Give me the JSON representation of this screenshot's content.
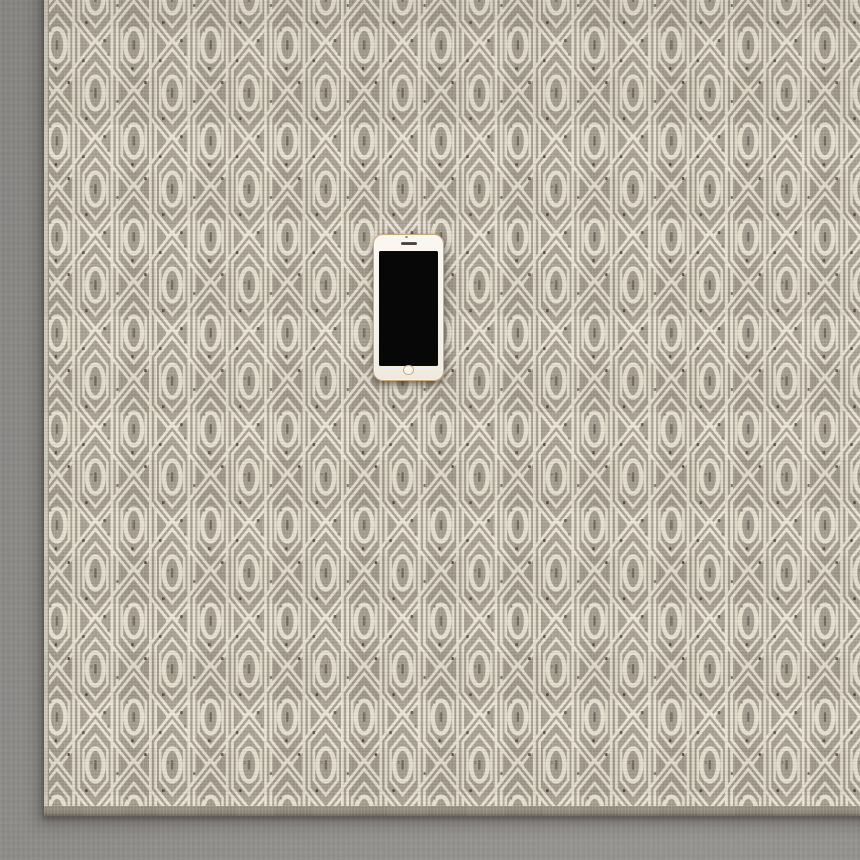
{
  "scene": {
    "description": "Overhead photo of a smartphone with its screen off, lying face-up on a gray-taupe geometric flat-weave area rug placed on a gray concrete floor",
    "floor": {
      "label": "gray concrete floor"
    },
    "rug": {
      "label": "geometric hexagon flat-weave area rug",
      "pattern": "half-drop elongated hexagons with inner outline, center oval and tip diamonds, cream on taupe, with dark woven flecks",
      "edges": {
        "left": "cream selvedge strip",
        "bottom": "dark taupe binding"
      }
    },
    "phone": {
      "label": "smartphone lying face-up",
      "state": "screen off",
      "parts": {
        "screen": "black rectangular display",
        "speaker": "earpiece speaker slot",
        "camera": "front camera dot",
        "sensor": "proximity sensor dot",
        "home_button": "circular home button with gold ring"
      }
    }
  },
  "colors": {
    "floor": "#8f8d8a",
    "floor_light": "#989693",
    "rug_ground": "#a39a8c",
    "rug_ground_dark": "#948c7f",
    "rug_cream": "#e9e2d2",
    "rug_fleck_dark": "#36322b",
    "rug_fleck_mid": "#6e675c",
    "rug_selvedge": "#d7d1c3",
    "rug_binding": "#8b8477",
    "rug_edge_dark": "#5f594e",
    "phone_body": "#f7f3ec",
    "phone_rim": "#d0a97a",
    "phone_screen": "#070707",
    "phone_home_ring": "#c9a87c",
    "phone_speaker": "#46423b",
    "phone_camera": "#6f6a62",
    "phone_sensor": "#968e82"
  }
}
